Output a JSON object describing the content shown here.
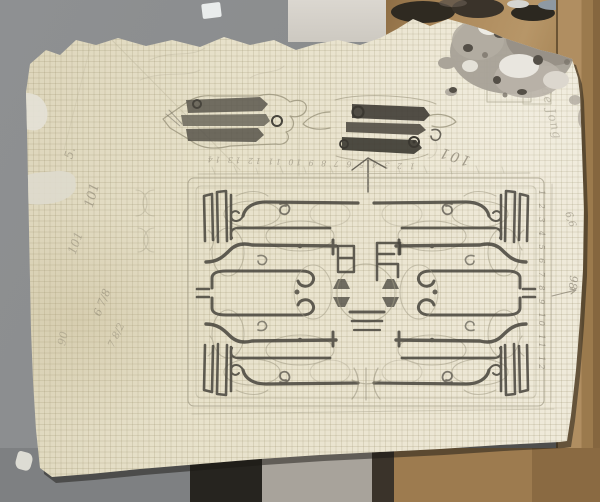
{
  "annotations": {
    "top_101": "101",
    "top_tick_row": "1 2 3 4 5 6 7 8 9 10 11 12 13 14",
    "right_tick_column": "1 2 3 4 5 6 7 8 9 10 11 12",
    "right_98": "98",
    "right_66": "6,6",
    "right_cursive": "de Jong",
    "left_a": "5.",
    "left_b": "101",
    "left_c": "101",
    "left_d": "6 7/8",
    "left_e": "7 8/2",
    "left_f": "90"
  },
  "palette": {
    "background_gray": "#8a8c8d",
    "backing_brown": "#ad8a5c",
    "paper_cream": "#e7e1ca",
    "pencil_dark": "#47443c",
    "pencil_light": "#a09a84",
    "stain_gray": "#a7a197"
  }
}
